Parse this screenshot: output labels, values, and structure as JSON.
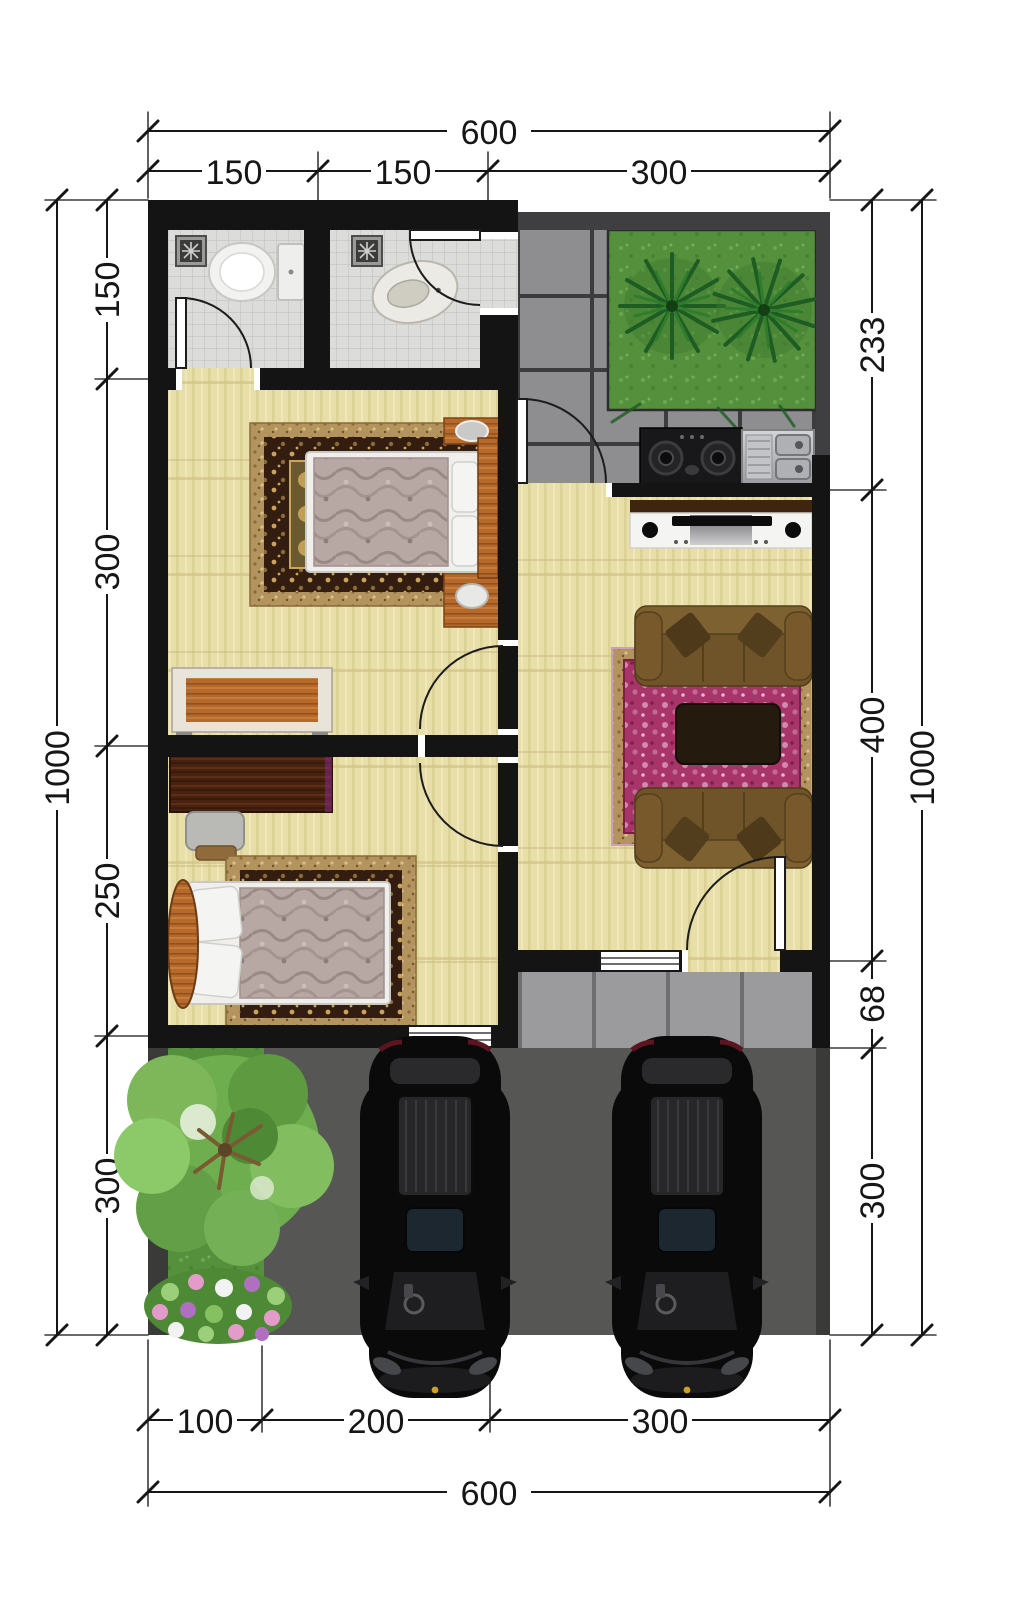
{
  "dimensions": {
    "top": {
      "total": "600",
      "segments": [
        "150",
        "150",
        "300"
      ]
    },
    "left": {
      "total": "1000",
      "segments": [
        "150",
        "300",
        "250",
        "300"
      ]
    },
    "right": {
      "total": "1000",
      "segments": [
        "233",
        "400",
        "68",
        "300"
      ]
    },
    "bottom": {
      "total": "600",
      "segments": [
        "100",
        "200",
        "300"
      ]
    }
  },
  "palette": {
    "wall": "#141414",
    "wood_floor": "#e8dfa8",
    "bathroom_tile": "#dcdcda",
    "paving_tile": "#8e8e90",
    "grout": "#3c3c3e",
    "porch_tile": "#9b9b9d",
    "carport": "#565654",
    "grass": "#55913c",
    "garden_palm": "#1d5c22",
    "sofa": "#6e5428",
    "living_rug": "#a8356a",
    "rug_border_gold": "#b3945e",
    "furniture_wood": "#b5692a",
    "car_body": "#0a0a0b",
    "dimension_text": "#161616"
  }
}
